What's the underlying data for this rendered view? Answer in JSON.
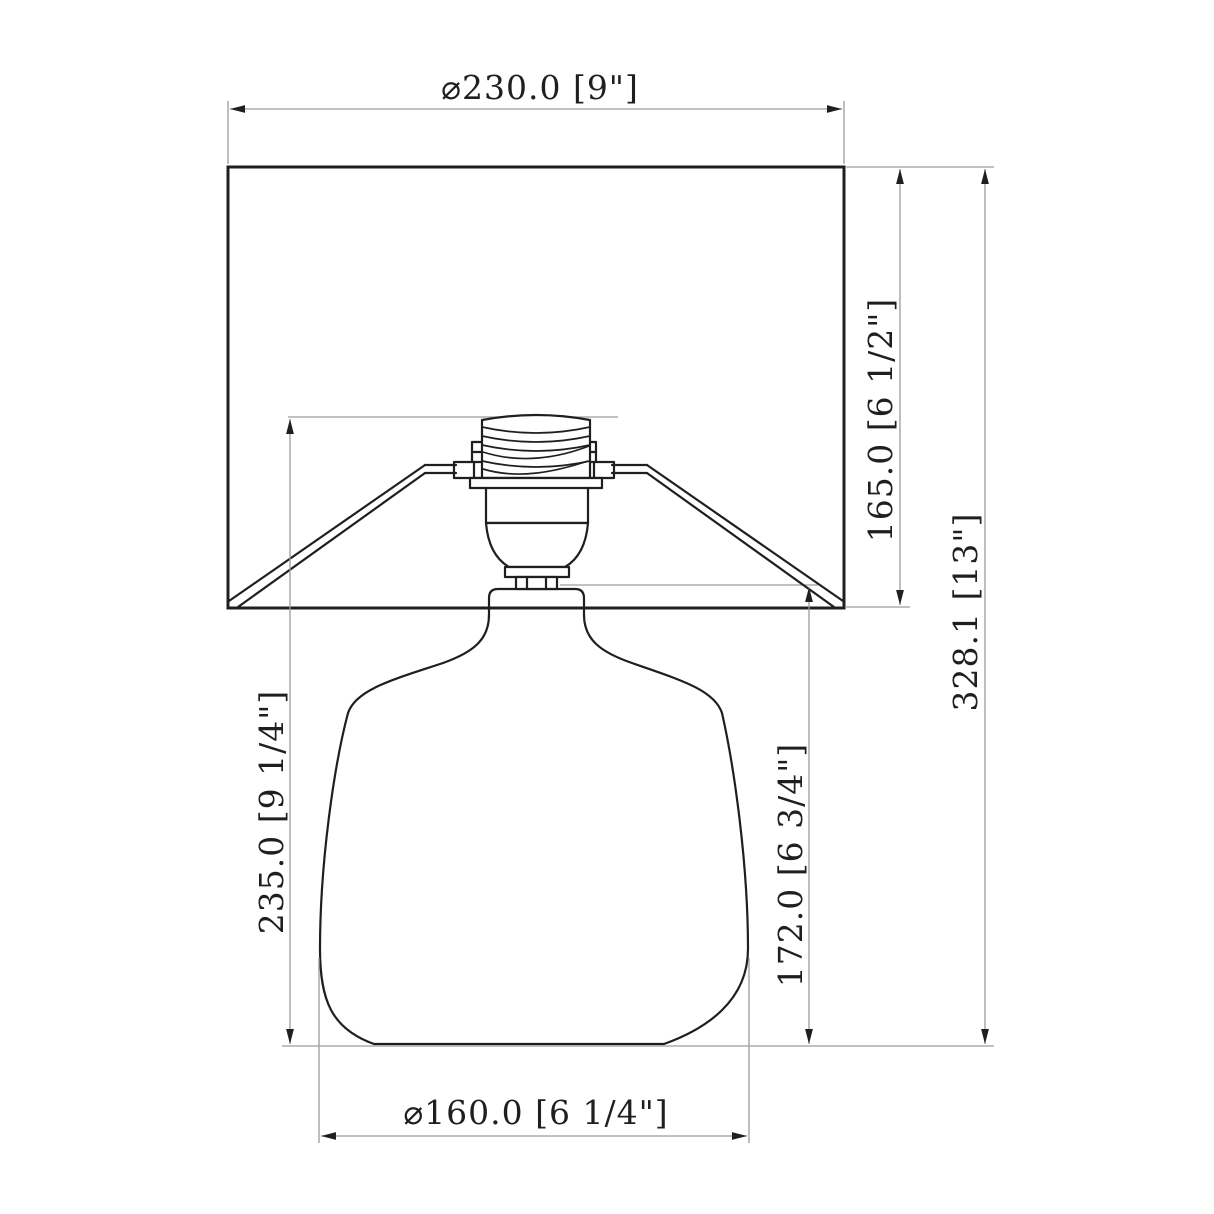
{
  "drawing": {
    "subject": "table-lamp-front-elevation-dimension-drawing",
    "units": "millimeters [inches]",
    "colors": {
      "background": "#ffffff",
      "object_line": "#1f1f1f",
      "dimension_line": "#9c9c9c",
      "text": "#1f1f1f"
    },
    "dimensions": {
      "shade_diameter": {
        "label": "⌀230.0 [9\"]",
        "orientation": "horizontal",
        "position": "top",
        "measures": "shade width"
      },
      "shade_height": {
        "label": "165.0 [6 1/2\"]",
        "orientation": "vertical",
        "position": "right-inner",
        "measures": "shade height"
      },
      "overall_height": {
        "label": "328.1 [13\"]",
        "orientation": "vertical",
        "position": "right-outer",
        "measures": "overall lamp height"
      },
      "socket_to_base_height": {
        "label": "235.0 [9 1/4\"]",
        "orientation": "vertical",
        "position": "left",
        "measures": "height from socket top to base bottom"
      },
      "body_height": {
        "label": "172.0 [6 3/4\"]",
        "orientation": "vertical",
        "position": "middle-right",
        "measures": "lamp body height"
      },
      "base_diameter": {
        "label": "⌀160.0 [6 1/4\"]",
        "orientation": "horizontal",
        "position": "bottom",
        "measures": "base width"
      }
    }
  }
}
